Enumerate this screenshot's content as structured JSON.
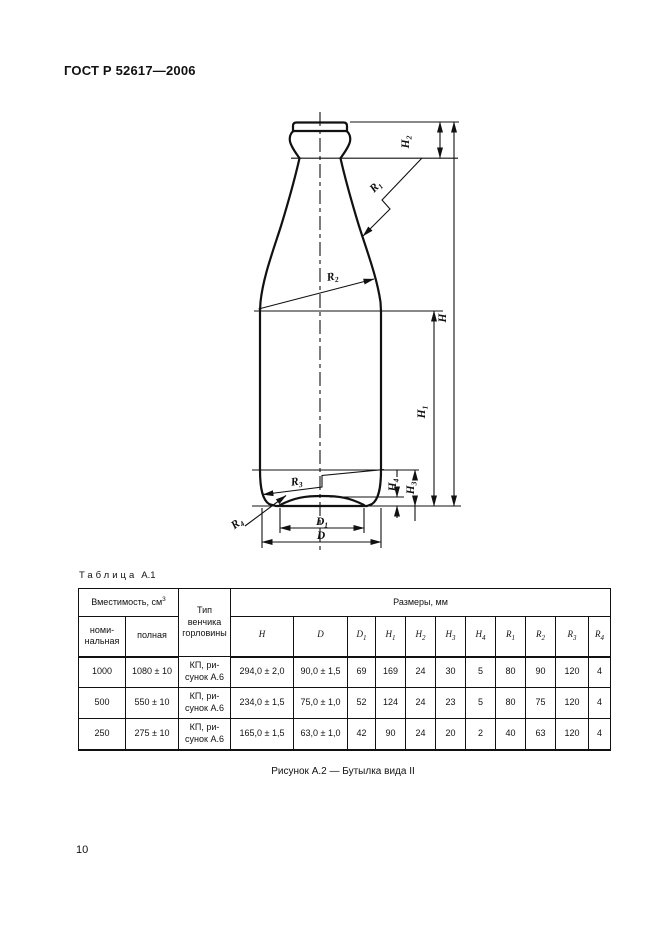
{
  "page": {
    "standard_code": "ГОСТ Р 52617—2006",
    "page_number": "10"
  },
  "figure": {
    "caption": "Рисунок А.2 — Бутылка вида II"
  },
  "drawing": {
    "labels": {
      "H": {
        "main": "H",
        "sub": ""
      },
      "H1": {
        "main": "H",
        "sub": "1"
      },
      "H2": {
        "main": "H",
        "sub": "2"
      },
      "H3": {
        "main": "H",
        "sub": "3"
      },
      "H4": {
        "main": "H",
        "sub": "4"
      },
      "R1": {
        "main": "R",
        "sub": "1"
      },
      "R2": {
        "main": "R",
        "sub": "2"
      },
      "R3": {
        "main": "R",
        "sub": "3"
      },
      "R4": {
        "main": "R",
        "sub": "4"
      },
      "D": {
        "main": "D",
        "sub": ""
      },
      "D1": {
        "main": "D",
        "sub": "1"
      }
    }
  },
  "table": {
    "label_word": "Таблица",
    "label_num": "А.1",
    "capacity_header": {
      "text": "Вместимость, см",
      "sup": "3"
    },
    "capacity_sub": {
      "nominal": "номи-\nнальная",
      "full": "полная"
    },
    "finish_type_header": "Тип\nвенчика\nгорловины",
    "dimensions_header": "Размеры, мм",
    "dim_cols": [
      {
        "main": "H",
        "sub": ""
      },
      {
        "main": "D",
        "sub": ""
      },
      {
        "main": "D",
        "sub": "1"
      },
      {
        "main": "H",
        "sub": "1"
      },
      {
        "main": "H",
        "sub": "2"
      },
      {
        "main": "H",
        "sub": "3"
      },
      {
        "main": "H",
        "sub": "4"
      },
      {
        "main": "R",
        "sub": "1"
      },
      {
        "main": "R",
        "sub": "2"
      },
      {
        "main": "R",
        "sub": "3"
      },
      {
        "main": "R",
        "sub": "4"
      }
    ],
    "rows": [
      [
        "1000",
        "1080 ± 10",
        "КП, ри-\nсунок А.6",
        "294,0 ± 2,0",
        "90,0 ± 1,5",
        "69",
        "169",
        "24",
        "30",
        "5",
        "80",
        "90",
        "120",
        "4"
      ],
      [
        "500",
        "550 ± 10",
        "КП, ри-\nсунок А.6",
        "234,0 ± 1,5",
        "75,0 ± 1,0",
        "52",
        "124",
        "24",
        "23",
        "5",
        "80",
        "75",
        "120",
        "4"
      ],
      [
        "250",
        "275 ± 10",
        "КП, ри-\nсунок А.6",
        "165,0 ± 1,5",
        "63,0 ± 1,0",
        "42",
        "90",
        "24",
        "20",
        "2",
        "40",
        "63",
        "120",
        "4"
      ]
    ]
  }
}
